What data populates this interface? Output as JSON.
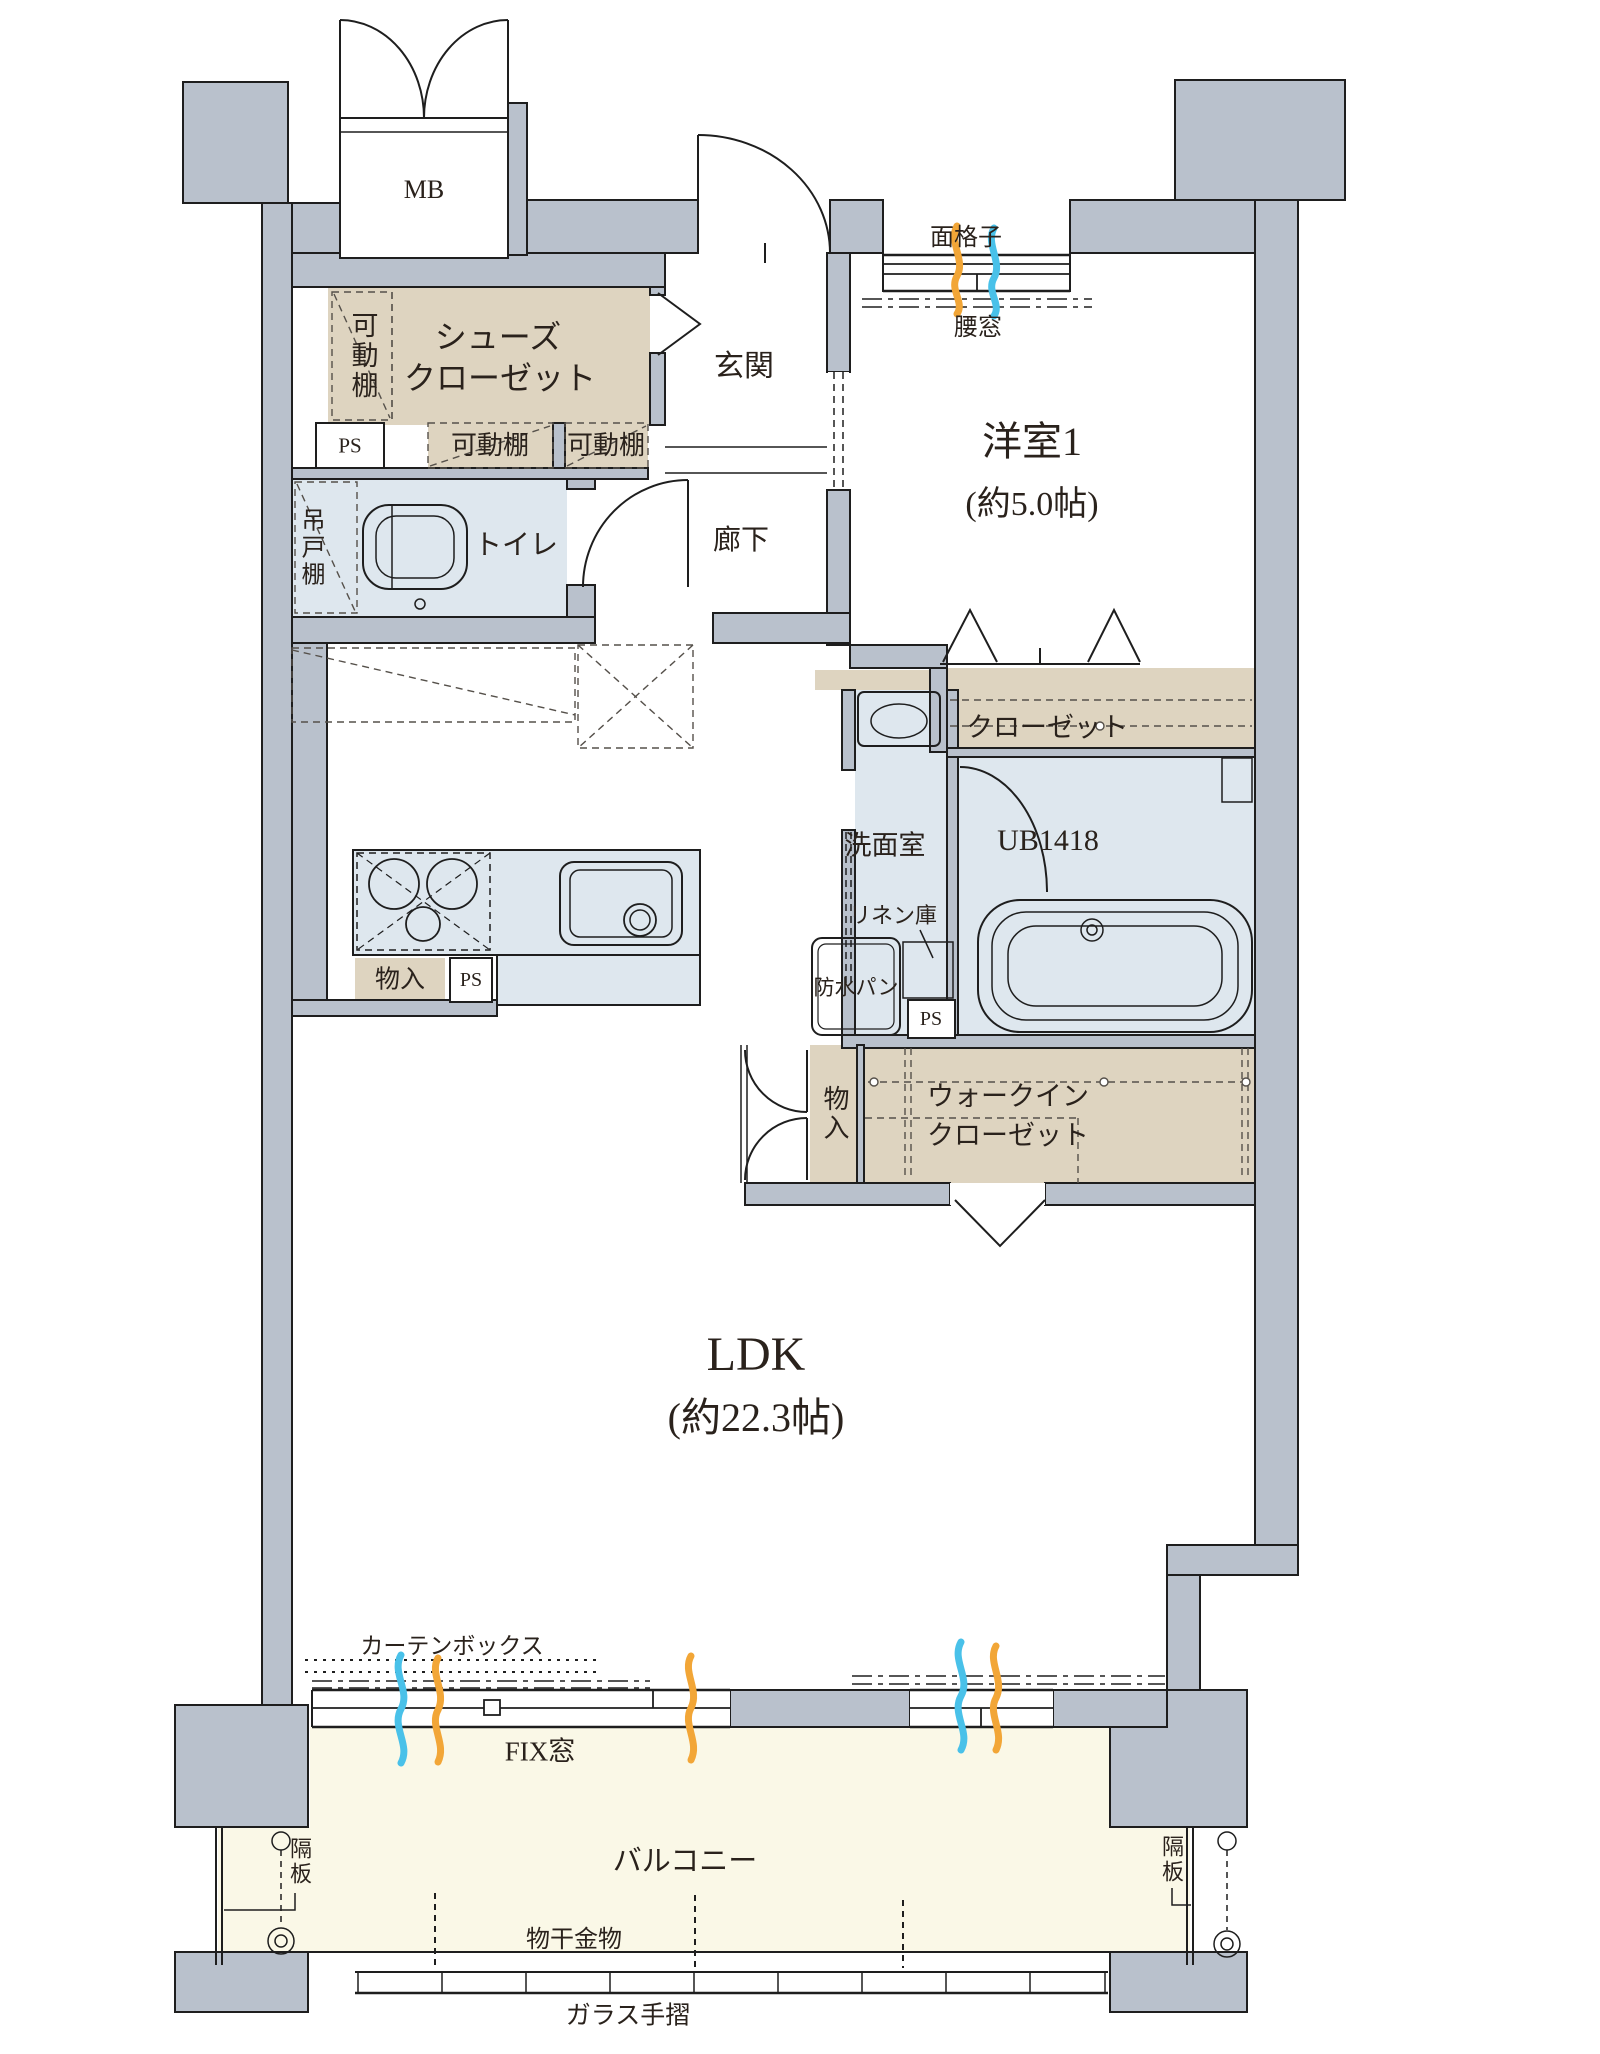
{
  "colors": {
    "wall": "#b9c1cc",
    "storage_fill": "#ded4c0",
    "wet_fill": "#dee7ee",
    "balcony_fill": "#faf8e7",
    "airflow_blue": "#49c1e9",
    "airflow_orange": "#f2a637",
    "ink": "#2a221c"
  },
  "rooms": {
    "western1": {
      "name": "洋室1",
      "size": "(約5.0帖)"
    },
    "ldk": {
      "name": "LDK",
      "size": "(約22.3帖)"
    },
    "entrance": "玄関",
    "hallway": "廊下",
    "toilet": "トイレ",
    "washroom": "洗面室",
    "unit_bath": "UB1418",
    "closet": "クローゼット",
    "walk_in_closet": {
      "line1": "ウォークイン",
      "line2": "クローゼット"
    },
    "shoes_closet": {
      "line1": "シューズ",
      "line2": "クローゼット"
    },
    "balcony": "バルコニー",
    "meter_box": "MB"
  },
  "features": {
    "movable_shelf_side": "可動棚",
    "movable_shelf_a": "可動棚",
    "movable_shelf_b": "可動棚",
    "hanging_cupboard": "吊戸棚",
    "pipe_space_a": "PS",
    "pipe_space_b": "PS",
    "pipe_space_c": "PS",
    "storage_a": "物入",
    "storage_b": "物入",
    "linen_storage": "リネン庫",
    "waterproof_pan": "防水パン",
    "face_grille": "面格子",
    "waist_window": "腰窓",
    "curtain_box": "カーテンボックス",
    "fix_window": "FIX窓",
    "partition_left": "隔板",
    "partition_right": "隔板",
    "laundry_hanger": "物干金物",
    "glass_handrail": "ガラス手摺"
  }
}
